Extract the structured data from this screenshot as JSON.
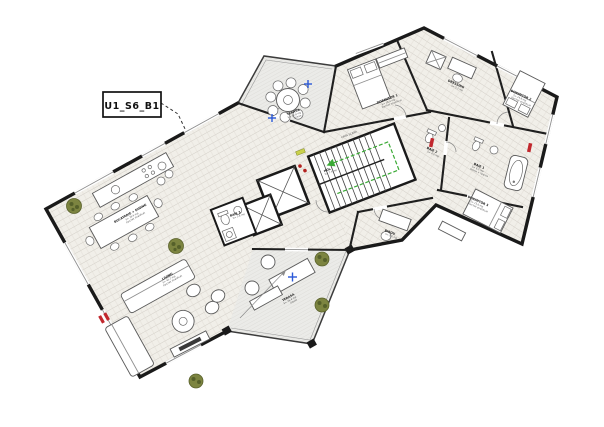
{
  "meta": {
    "tag_label": "U1_S6_B1"
  },
  "palette": {
    "wall": "#1a1a1a",
    "floor": "#f1efe9",
    "hatch": "#ccc8c0",
    "terrace_floor": "#ebebe8",
    "plant_green": "#7c8440",
    "marker_red": "#c1272d",
    "arrow_green": "#3aaa35",
    "symbol_blue": "#2b59d8"
  },
  "rooms": {
    "dining": {
      "name": "BUCATARIE + DINING",
      "area": "S= 28.6 mp",
      "finish": "Parchet stratificat"
    },
    "living": {
      "name": "LIVING",
      "area": "S= 41.2 mp",
      "finish": "Parchet stratificat"
    },
    "terrace_top": {
      "name": "TERASA",
      "area": "S= 12.8 mp",
      "finish": "Gresie"
    },
    "terrace_bottom": {
      "name": "TERASA",
      "area": "S= 26.4 mp",
      "finish": "Gresie"
    },
    "dorm1": {
      "name": "DORMITOR 1",
      "area": "S= 16.4 mp",
      "finish": "Parchet stratificat"
    },
    "dorm2": {
      "name": "DORMITOR 2",
      "area": "S= 14.8 mp",
      "finish": "Parchet stratificat"
    },
    "dorm3": {
      "name": "DORMITOR 3",
      "area": "S= 15.6 mp",
      "finish": "Parchet stratificat"
    },
    "dressing": {
      "name": "DRESSING",
      "area": "S= 5.2 mp",
      "finish": "Parchet"
    },
    "bath1": {
      "name": "BAIE 1",
      "area": "S= 6.2 mp",
      "finish": "Gresie + faianta"
    },
    "bath2": {
      "name": "BAIE 2",
      "area": "S= 4.6 mp",
      "finish": "Gresie + faianta"
    },
    "bath3": {
      "name": "BAIE 3",
      "area": "S= 3.8 mp",
      "finish": "Gresie + faianta"
    },
    "office": {
      "name": "BIROU",
      "area": "S= 9.2 mp",
      "finish": "Parchet"
    },
    "hall": {
      "name": "HOL",
      "area": "S= 7.4 mp"
    },
    "stairs": {
      "name": "CASA SCARII"
    }
  }
}
